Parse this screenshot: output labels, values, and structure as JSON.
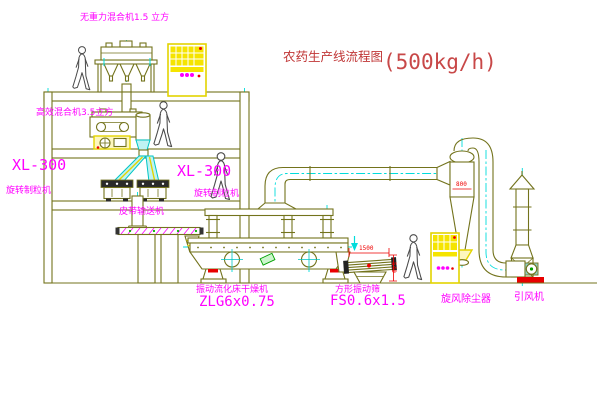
{
  "title": {
    "cn": "农药生产线流程图",
    "capacity": "(500kg/h)"
  },
  "labels": {
    "top_mixer": "无重力混合机1.5 立方",
    "floor2_mixer": "高效混合机3.5立方",
    "granulator_left_model": "XL-300",
    "granulator_left_name": "旋转制粒机",
    "granulator_right_model": "XL-300",
    "granulator_right_name": "旋转制粒机",
    "belt_conveyor": "皮带输送机",
    "dryer_name": "振动流化床干燥机",
    "dryer_model": "ZLG6x0.75",
    "sieve_name": "方形振动筛",
    "sieve_model": "FS0.6x1.5",
    "cyclone_name": "旋风除尘器",
    "fan_name": "引风机"
  },
  "dims": {
    "sieve_length": "1500",
    "sieve_height": "540",
    "cyclone_dia": "800"
  },
  "colors": {
    "line": "#73731c",
    "centerline": "#00dcdc",
    "label": "#ff00ff",
    "highlight": "#e3d400",
    "dimension": "#ee0000",
    "title": "#c03636",
    "background": "#ffffff"
  }
}
